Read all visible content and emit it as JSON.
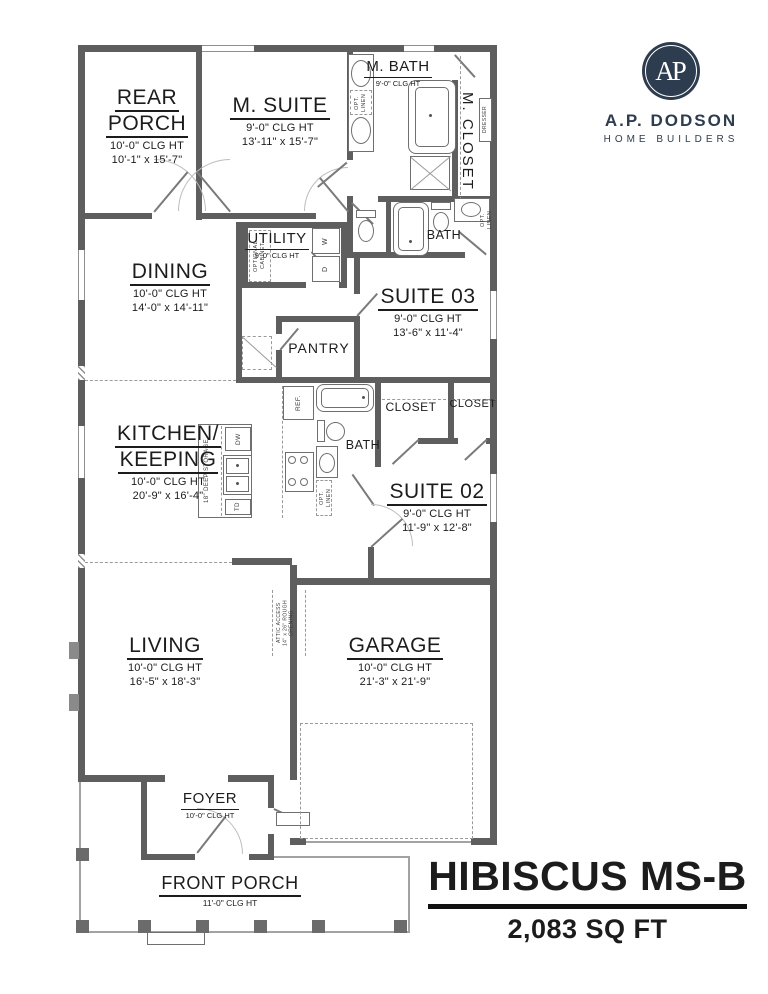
{
  "colors": {
    "navy": "#2d3c4e",
    "wall_gray": "#5e5e5e"
  },
  "branding": {
    "monogram": "AP",
    "company": "A.P. DODSON",
    "tagline": "HOME BUILDERS"
  },
  "title": {
    "plan_name": "HIBISCUS MS-B",
    "area": "2,083 SQ FT"
  },
  "rooms": {
    "rear_porch": {
      "lines": [
        "REAR",
        "PORCH"
      ],
      "clg": "10'-0\" CLG HT",
      "dims": "10'-1\" x 15'-7\""
    },
    "m_suite": {
      "lines": [
        "M. SUITE"
      ],
      "clg": "9'-0\" CLG HT",
      "dims": "13'-11\" x 15'-7\""
    },
    "m_bath": {
      "name": "M. BATH",
      "clg": "9'-0\" CLG HT"
    },
    "m_closet": {
      "name": "M. CLOSET"
    },
    "bath_top": {
      "name": "BATH"
    },
    "utility": {
      "name": "UTILITY",
      "clg": "9'-0\" CLG HT"
    },
    "dining": {
      "lines": [
        "DINING"
      ],
      "clg": "10'-0\" CLG HT",
      "dims": "14'-0\" x 14'-11\""
    },
    "suite_03": {
      "lines": [
        "SUITE 03"
      ],
      "clg": "9'-0\" CLG HT",
      "dims": "13'-6\" x 11'-4\""
    },
    "pantry": {
      "name": "PANTRY"
    },
    "kitchen": {
      "lines": [
        "KITCHEN/",
        "KEEPING"
      ],
      "clg": "10'-0\" CLG HT",
      "dims": "20'-9\" x 16'-4\""
    },
    "bath_mid": {
      "name": "BATH"
    },
    "closet_1": {
      "name": "CLOSET"
    },
    "closet_2": {
      "name": "CLOSET"
    },
    "suite_02": {
      "lines": [
        "SUITE 02"
      ],
      "clg": "9'-0\" CLG HT",
      "dims": "11'-9\" x 12'-8\""
    },
    "living": {
      "lines": [
        "LIVING"
      ],
      "clg": "10'-0\" CLG HT",
      "dims": "16'-5\" x 18'-3\""
    },
    "garage": {
      "lines": [
        "GARAGE"
      ],
      "clg": "10'-0\" CLG HT",
      "dims": "21'-3\" x 21'-9\""
    },
    "foyer": {
      "name": "FOYER",
      "clg": "10'-0\" CLG HT"
    },
    "front_porch": {
      "name": "FRONT PORCH",
      "clg": "11'-0\" CLG HT"
    }
  },
  "fixtures": {
    "washer": "W",
    "dryer": "D",
    "dishwasher": "DW",
    "trash_drawer": "TD",
    "fridge": "REF.",
    "opt_linen_l1": "OPT.",
    "opt_linen_l2": "LINEN",
    "optional_cabinet_l1": "OPTIONAL",
    "optional_cabinet_l2": "CABINET",
    "dresser": "DRESSER",
    "deep_storage": "18\" DEEP STORAGE"
  },
  "notes": {
    "attic": [
      "ATTIC ACCESS",
      "14\" x 26\" ROUGH",
      "OPENING"
    ]
  }
}
